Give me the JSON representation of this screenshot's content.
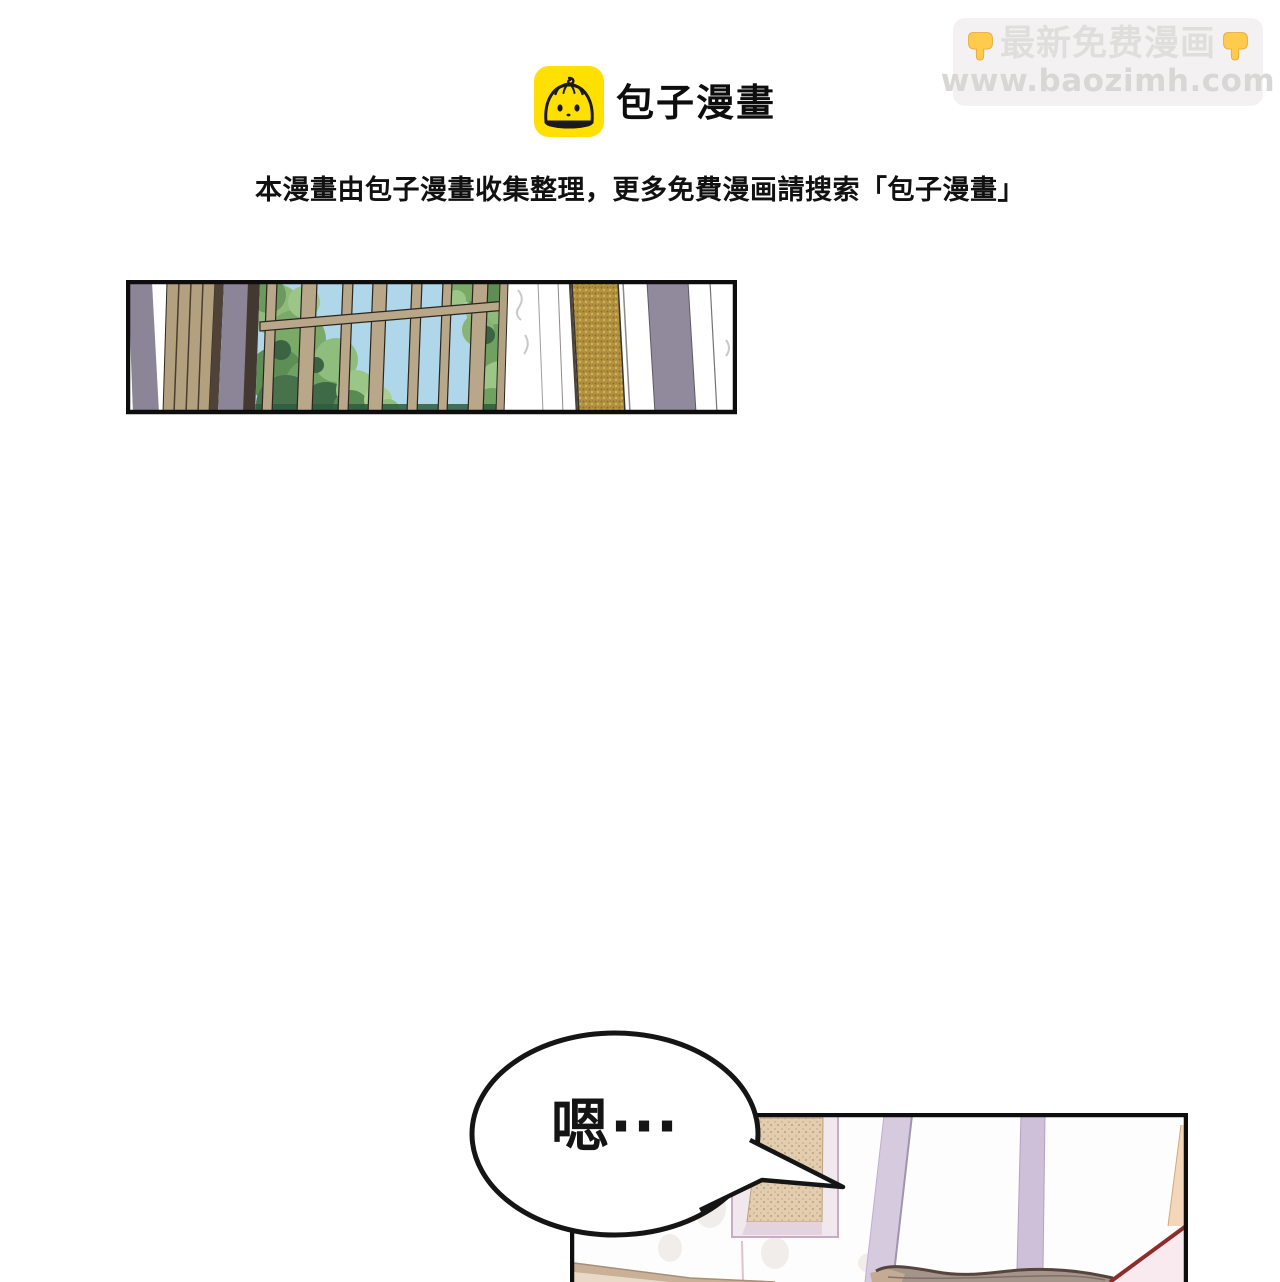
{
  "promo_banner": {
    "line1": "最新免费漫画",
    "line2": "www.baozimh.com",
    "icon_left": "pointing-down-hand",
    "icon_right": "pointing-down-hand",
    "bg_color": "#f3f1f1",
    "text_color": "#e0dddd",
    "hand_color": "#FFCB4C"
  },
  "logo": {
    "app_name": "包子漫畫",
    "icon": "baozi-bun-face",
    "icon_bg": "#FFE000",
    "icon_line_color": "#1a1a1a"
  },
  "notice_line": "本漫畫由包子漫畫收集整理，更多免費漫画請搜索「包子漫畫」",
  "speech_bubble": {
    "text": "嗯···",
    "stroke_color": "#151515"
  },
  "panels": {
    "panel1_description": "corridor wall: purple-gray pilasters, wood planks, paned window with green foliage and blue sky, white marble wall with gold and purple trim strips",
    "panel2_description": "room wall: framed tan wall panel, lavender drape strips, couch back at bottom, dark-red diagonal and peach trim at right edge"
  },
  "palette": {
    "panel_border": "#0d0d0d",
    "purple_strip": "#8c8497",
    "wood_plank": "#b2a07f",
    "dark_wood": "#4f4337",
    "window_frame_tan": "#b9a78a",
    "sky_blue": "#b0d7e9",
    "foliage_light": "#9cc687",
    "foliage_mid": "#6fa161",
    "foliage_dark": "#3b6443",
    "gold_trim": "#b29140",
    "lavender_strip": "#d6cade",
    "frame_pink": "#c9abc4",
    "panel_tan": "#e2cdb0",
    "couch_brown": "#a4948a",
    "couch_outline": "#55453c",
    "accent_red": "#8e2b2b",
    "peach": "#f4d7ba",
    "pale_pink": "#f8eaee"
  }
}
